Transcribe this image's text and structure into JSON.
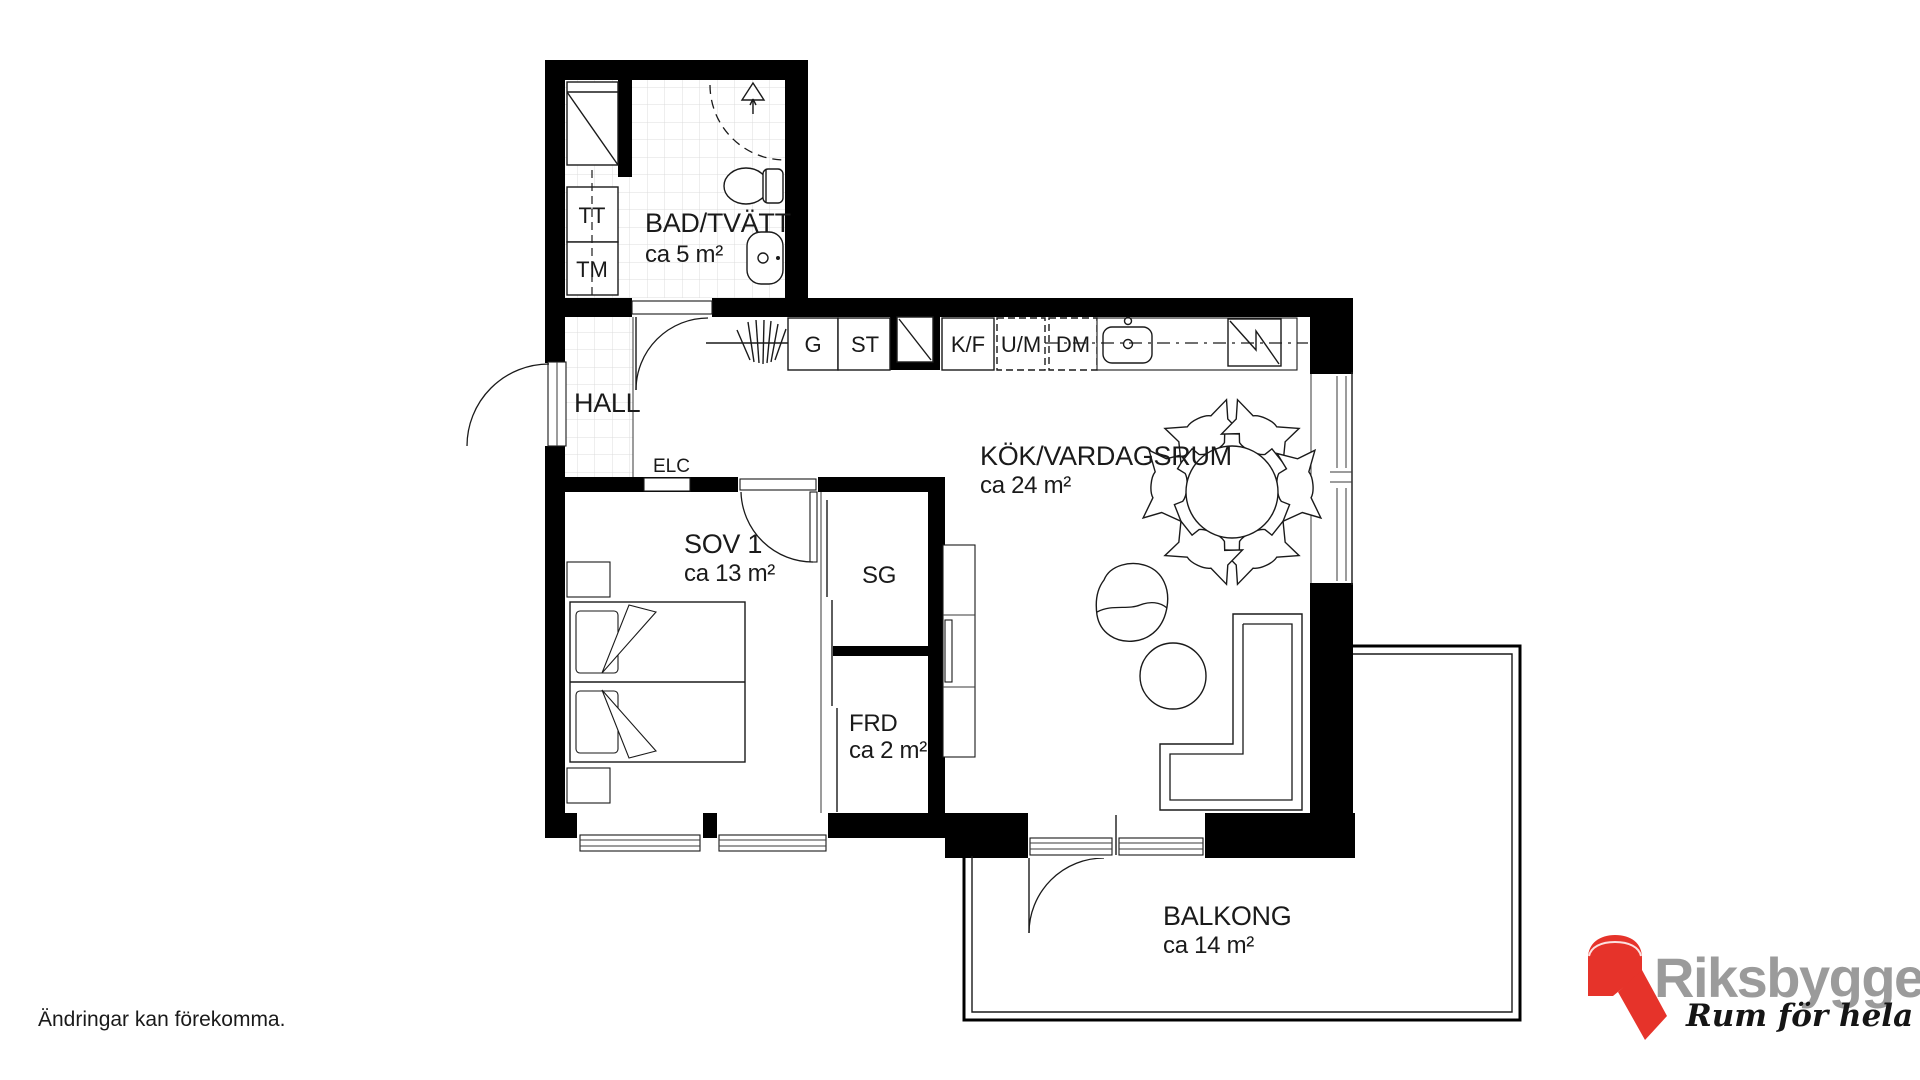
{
  "plan": {
    "bathroom": {
      "name": "BAD/TVÄTT",
      "area": "ca 5 m²",
      "dryer_label": "TT",
      "washer_label": "TM"
    },
    "hall": {
      "name": "HALL",
      "electrical_label": "ELC"
    },
    "kitchen_living": {
      "name": "KÖK/VARDAGSRUM",
      "area": "ca 24 m²"
    },
    "kitchen_units": {
      "wardrobe": "G",
      "cleaning": "ST",
      "fridge_freezer": "K/F",
      "oven_micro": "U/M",
      "dishwasher": "DM"
    },
    "bedroom": {
      "name": "SOV 1",
      "area": "ca 13 m²"
    },
    "sliding_wardrobe": {
      "name": "SG"
    },
    "storage": {
      "name": "FRD",
      "area": "ca 2 m²"
    },
    "balcony": {
      "name": "BALKONG",
      "area": "ca 14 m²"
    }
  },
  "footer": {
    "disclaimer": "Ändringar kan förekomma."
  },
  "logo": {
    "brand": "Riksbyggen",
    "tagline": "Rum för hela livet",
    "brand_color": "#9B9B9B",
    "mark_color": "#E6332A"
  },
  "colors": {
    "walls": "#000000",
    "lines": "#1A1A1A",
    "tiles": "#DCDCDC"
  }
}
